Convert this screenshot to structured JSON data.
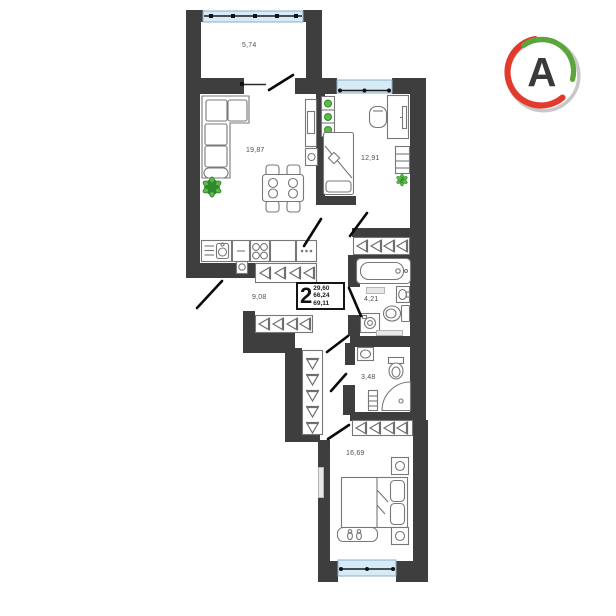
{
  "logo": {
    "letter": "A"
  },
  "plan": {
    "unit_box": {
      "rooms_count": "2",
      "values": [
        "29,60",
        "66,24",
        "69,11"
      ]
    },
    "rooms": {
      "balcony": {
        "label": "5,74"
      },
      "living_kitchen": {
        "label": "19,87"
      },
      "office": {
        "label": "12,91"
      },
      "hallway": {
        "label": "9,08"
      },
      "bathroom": {
        "label": "4,21"
      },
      "wc": {
        "label": "3,48"
      },
      "bedroom": {
        "label": "16,69"
      }
    }
  },
  "colors": {
    "wall": "#3E3E3E",
    "window": "#D5EBF7",
    "logo_red": "#E23B2E",
    "logo_green": "#5BA63C",
    "logo_gray": "#C8C8C8",
    "plant_green": "#5FBA46"
  }
}
